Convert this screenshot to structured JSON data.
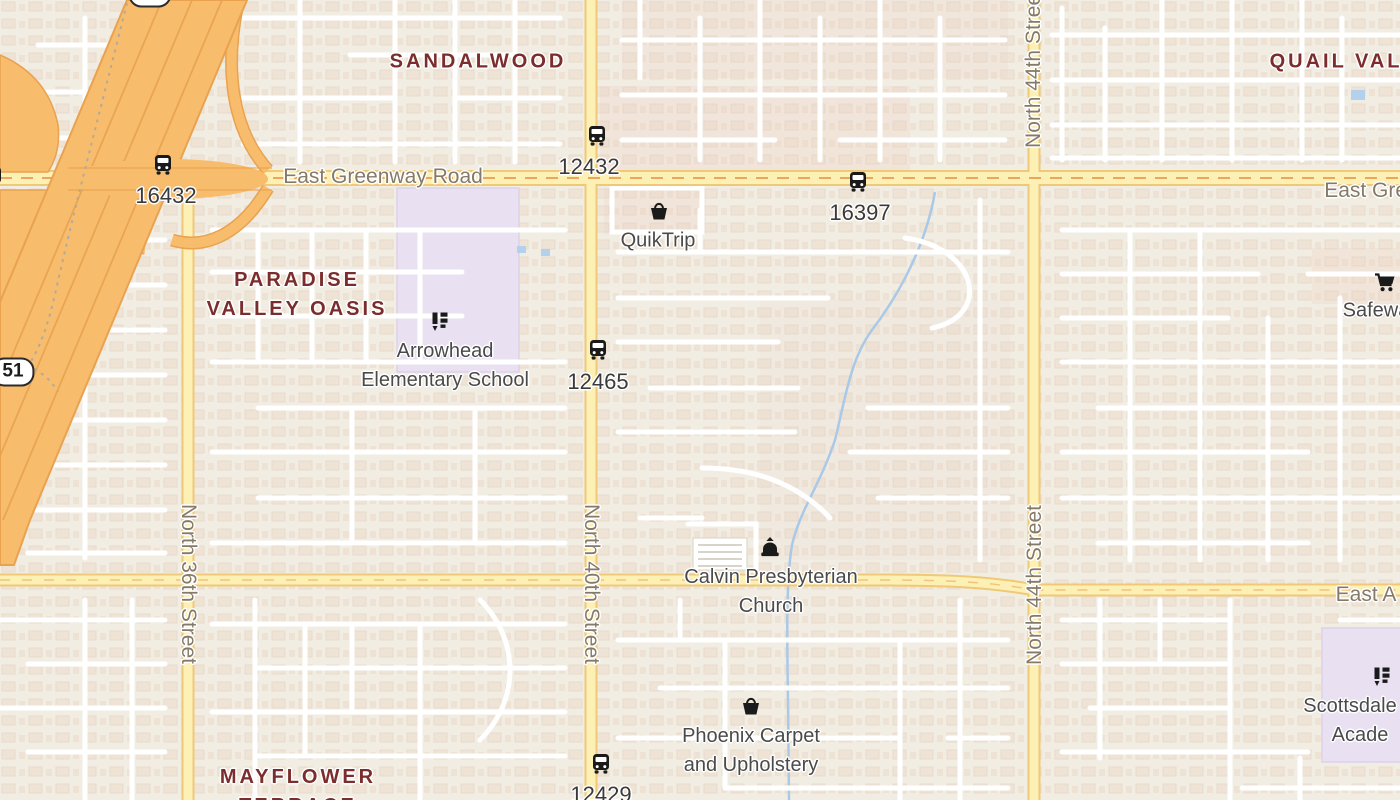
{
  "colors": {
    "land": "#f2ede3",
    "freeway": "#f7bd6d",
    "freeway_casing": "#e9a250",
    "secondary_road": "#fcf0b5",
    "secondary_casing": "#efc977",
    "minor_road": "#ffffff",
    "water": "#a9c9e8",
    "school_area": "#e9e0f2",
    "neighborhood_text": "#7b2c2c",
    "road_text": "#857a68",
    "poi_text": "#4a4a4a",
    "bus_text": "#3a3a3a"
  },
  "neighborhoods": [
    {
      "name": "Sandalwood",
      "lines": [
        "SANDALWOOD"
      ],
      "x": 478,
      "y": 62
    },
    {
      "name": "Paradise Valley Oasis",
      "lines": [
        "PARADISE",
        "VALLEY OASIS"
      ],
      "x": 297,
      "y": 295
    },
    {
      "name": "Quail Valley",
      "lines": [
        "QUAIL VALLEY"
      ],
      "x": 1360,
      "y": 62
    },
    {
      "name": "Mayflower Terrace",
      "lines": [
        "MAYFLOWER",
        "TERRACE"
      ],
      "x": 298,
      "y": 792
    }
  ],
  "road_labels": [
    {
      "text": "East Greenway Road",
      "x": 383,
      "y": 177,
      "dir": "h"
    },
    {
      "text": "East Greenway Road",
      "x": 1424,
      "y": 191,
      "dir": "h"
    },
    {
      "text": "East A",
      "x": 1366,
      "y": 595,
      "dir": "h"
    },
    {
      "text": "North 36th Street",
      "x": 188,
      "y": 584,
      "dir": "v90"
    },
    {
      "text": "North 40th Street",
      "x": 591,
      "y": 584,
      "dir": "v90"
    },
    {
      "text": "North 44th Street",
      "x": 1034,
      "y": 68,
      "dir": "v270"
    },
    {
      "text": "North 44th Street",
      "x": 1035,
      "y": 585,
      "dir": "v270"
    }
  ],
  "pois": [
    {
      "name": "QuikTrip",
      "icon": "shopping-basket-icon",
      "ix": 659,
      "iy": 211,
      "x": 658,
      "y": 241,
      "lines": [
        "QuikTrip"
      ]
    },
    {
      "name": "Arrowhead Elementary School",
      "icon": "school-icon",
      "ix": 440,
      "iy": 321,
      "x": 445,
      "y": 366,
      "lines": [
        "Arrowhead",
        "Elementary School"
      ]
    },
    {
      "name": "Calvin Presbyterian Church",
      "icon": "church-icon",
      "ix": 770,
      "iy": 547,
      "x": 771,
      "y": 592,
      "lines": [
        "Calvin Presbyterian",
        "Church"
      ]
    },
    {
      "name": "Phoenix Carpet and Upholstery",
      "icon": "shopping-basket-icon",
      "ix": 751,
      "iy": 706,
      "x": 751,
      "y": 751,
      "lines": [
        "Phoenix Carpet",
        "and Upholstery"
      ]
    },
    {
      "name": "Safeway",
      "icon": "shopping-cart-icon",
      "ix": 1385,
      "iy": 282,
      "x": 1381,
      "y": 311,
      "lines": [
        "Safeway"
      ]
    },
    {
      "name": "Scottsdale Academy",
      "icon": "school-icon",
      "ix": 1382,
      "iy": 676,
      "x": 1360,
      "y": 721,
      "lines": [
        "Scottsdale C",
        "Acade"
      ]
    }
  ],
  "bus_stops": [
    {
      "id": "16432",
      "ix": 163,
      "iy": 165,
      "x": 166,
      "y": 196
    },
    {
      "id": "12432",
      "ix": 597,
      "iy": 136,
      "x": 589,
      "y": 167
    },
    {
      "id": "16397",
      "ix": 858,
      "iy": 182,
      "x": 860,
      "y": 213
    },
    {
      "id": "12465",
      "ix": 598,
      "iy": 350,
      "x": 598,
      "y": 382
    },
    {
      "id": "12429",
      "ix": 601,
      "iy": 764,
      "x": 601,
      "y": 795
    },
    {
      "id": "",
      "ix": -7,
      "iy": 177,
      "x": -7,
      "y": 210
    }
  ],
  "shields": [
    {
      "route": "51",
      "x": 13,
      "y": 372
    },
    {
      "route": "51",
      "x": 150,
      "y": -7
    }
  ]
}
